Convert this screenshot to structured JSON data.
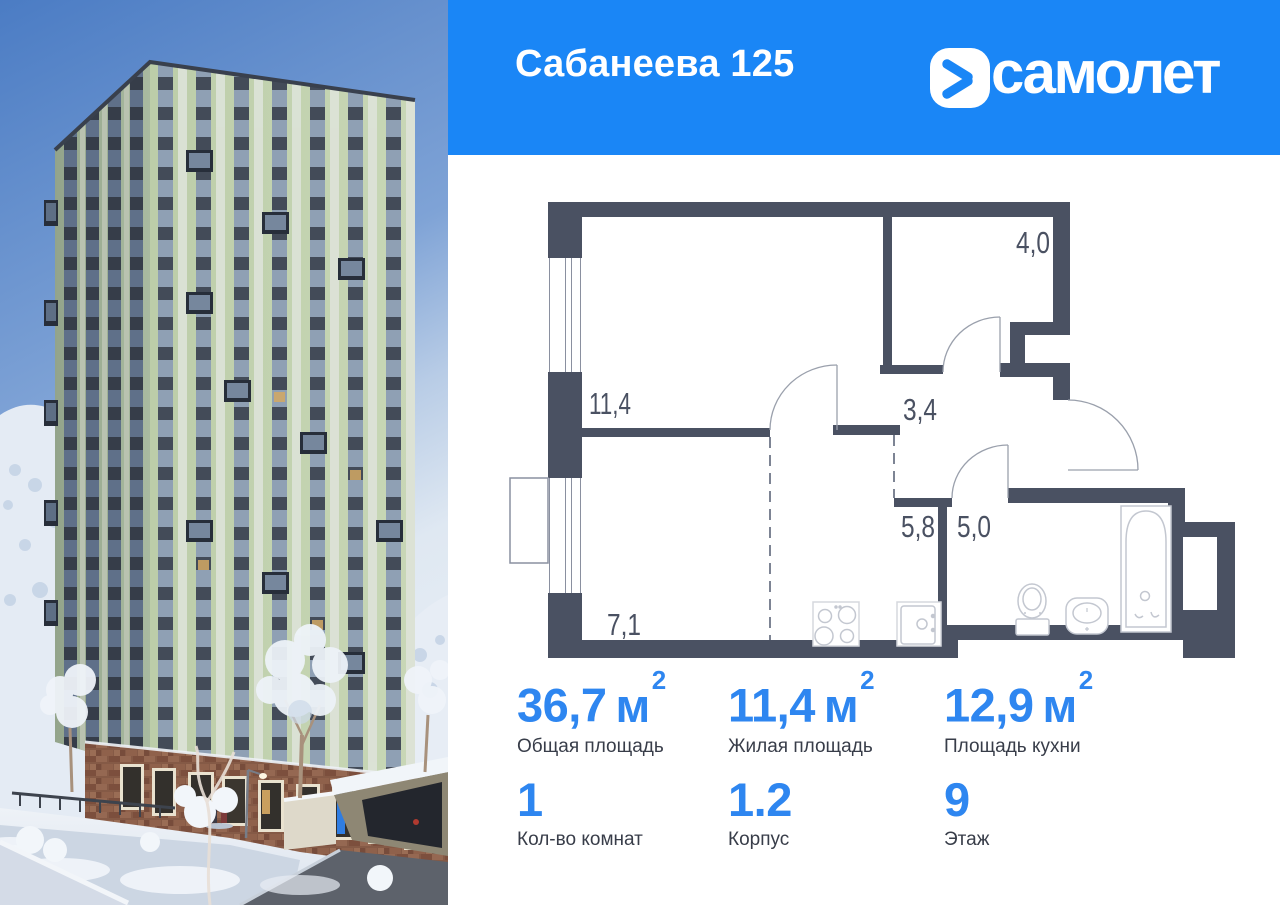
{
  "header": {
    "title": "Сабанеева 125",
    "brand_name": "самолет"
  },
  "floorplan": {
    "rooms": [
      {
        "name": "living-room",
        "area": "11,4"
      },
      {
        "name": "bedroom-niche",
        "area": "4,0"
      },
      {
        "name": "hallway",
        "area": "3,4"
      },
      {
        "name": "corridor",
        "area": "5,8"
      },
      {
        "name": "bathroom",
        "area": "5,0"
      },
      {
        "name": "kitchen-zone",
        "area": "7,1"
      }
    ]
  },
  "stats": {
    "areas": [
      {
        "value": "36,7",
        "unit": "м",
        "unit_sup": "2",
        "label": "Общая площадь"
      },
      {
        "value": "11,4",
        "unit": "м",
        "unit_sup": "2",
        "label": "Жилая площадь"
      },
      {
        "value": "12,9",
        "unit": "м",
        "unit_sup": "2",
        "label": "Площадь кухни"
      }
    ],
    "details": [
      {
        "value": "1",
        "label": "Кол-во комнат"
      },
      {
        "value": "1.2",
        "label": "Корпус"
      },
      {
        "value": "9",
        "label": "Этаж"
      }
    ]
  },
  "colors": {
    "header_blue": "#1a86f6",
    "accent_blue": "#2e86f0",
    "wall_color": "#4a5162"
  }
}
